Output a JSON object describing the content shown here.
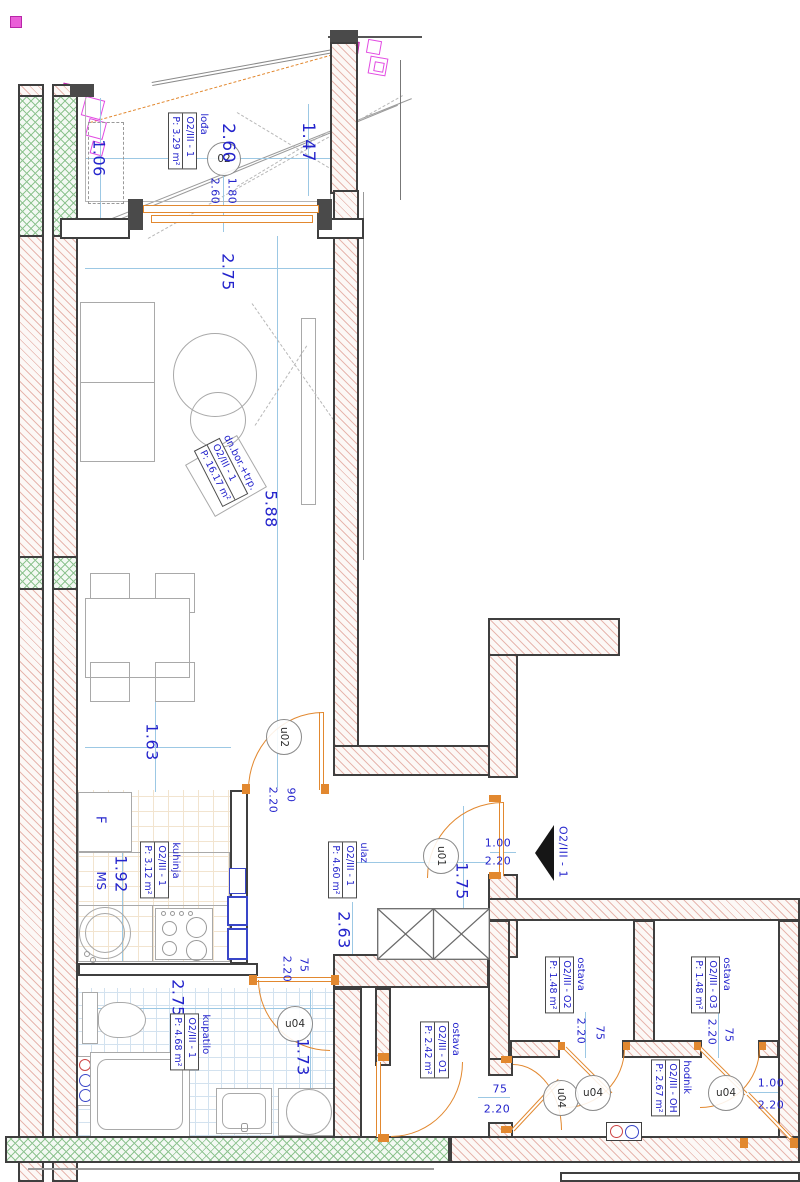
{
  "plan": {
    "unit": "O2/III - 1",
    "rooms": [
      {
        "name": "lođa",
        "code": "O2/III - 1",
        "area": "P: 3.29 m²"
      },
      {
        "name": "dn.bor.+trp.",
        "code": "O2/III - 1",
        "area": "P: 16.17 m²"
      },
      {
        "name": "kuhinja",
        "code": "O2/III - 1",
        "area": "P: 3.12 m²"
      },
      {
        "name": "ulaz",
        "code": "O2/III - 1",
        "area": "P: 4.60 m²"
      },
      {
        "name": "kupatilo",
        "code": "O2/III - 1",
        "area": "P: 4.68 m²"
      },
      {
        "name": "ostava",
        "code": "O2/III - O1",
        "area": "P: 2.42 m²"
      },
      {
        "name": "ostava",
        "code": "O2/III - O2",
        "area": "P: 1.48 m²"
      },
      {
        "name": "ostava",
        "code": "O2/III - O3",
        "area": "P: 1.48 m²"
      },
      {
        "name": "hodnik",
        "code": "O2/III - OH",
        "area": "P: 2.67 m²"
      }
    ],
    "door_tags": {
      "window02": "02",
      "u01": "u01",
      "u02": "u02",
      "u04": "u04"
    },
    "entry": {
      "arrow_label": "O2/III - 1",
      "w": "1.00",
      "h": "2.20"
    },
    "kitchen": {
      "fridge": "F",
      "ms": "MS"
    },
    "dims": {
      "loggia_d1": "1.06",
      "loggia_w": "2.60",
      "loggia_d2": "1.47",
      "win02_w": "1.80",
      "win02_h": "2.60",
      "living_w": "2.75",
      "living_h": "5.88",
      "living_part": "1.63",
      "kitchen_d": "1.92",
      "u02_w": "90",
      "u02_h": "2.20",
      "ulaz_w": "2.63",
      "ulaz_h": "1.75",
      "kup_w": "2.75",
      "kup_h": "1.73",
      "kup_door_w": "75",
      "kup_door_h": "2.20",
      "o1_door_w": "75",
      "o1_door_h": "2.20",
      "o2_door_w": "75",
      "o2_door_h": "2.20",
      "o3_door_w": "75",
      "o3_door_h": "2.20",
      "hod_door_w": "1.00",
      "hod_door_h": "2.20"
    },
    "colors": {
      "dim_text": "#2424cc",
      "door": "#e2882f",
      "wall_line": "#3f3f3f",
      "hatch": "#e7b7af",
      "insulation": "#8fc491",
      "dim_line": "#9cc8e4",
      "marker": "#e24ae2"
    }
  }
}
